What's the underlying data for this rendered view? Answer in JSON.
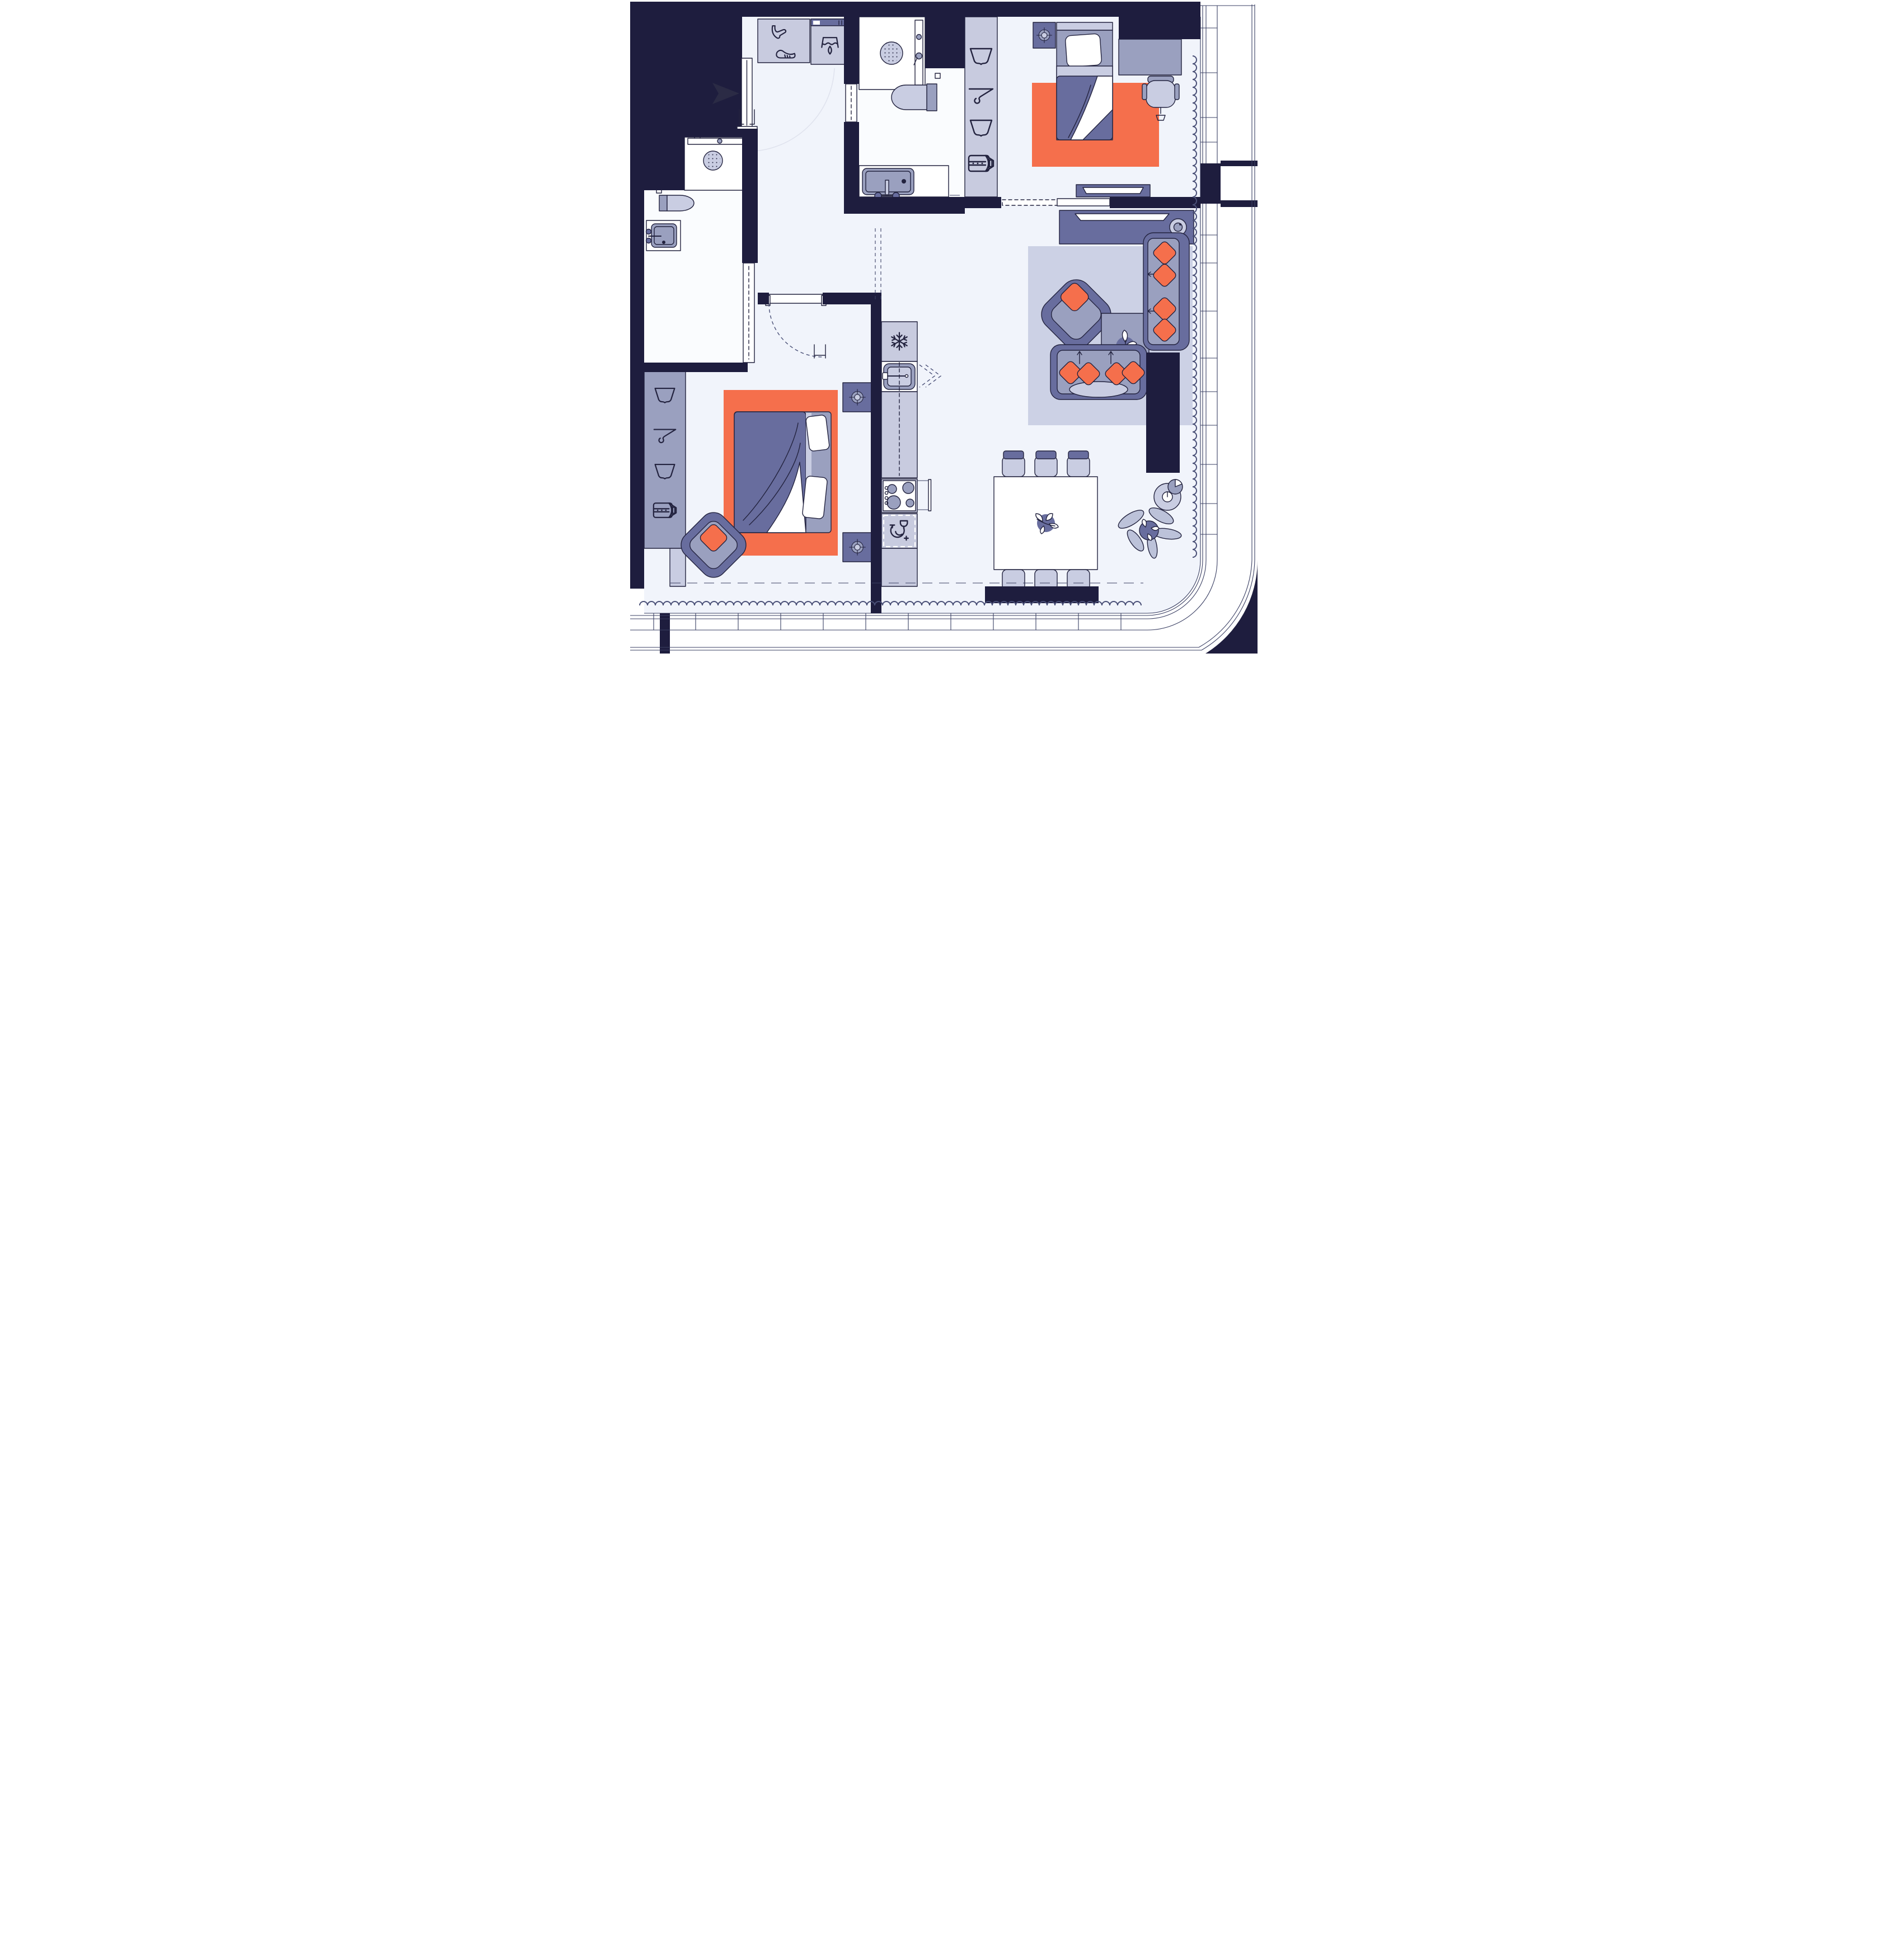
{
  "document": {
    "kind": "apartment-floor-plan",
    "view": "top-down architectural illustration",
    "visible_text": ""
  },
  "colors": {
    "wall": "#1e1d3e",
    "line": "#23233f",
    "line_soft": "#4a5077",
    "exterior_line": "#3a3f63",
    "floor": "#f1f4fb",
    "bath_floor": "#fafcfe",
    "white": "#ffffff",
    "cabinet_light": "#c8cbdf",
    "cabinet_mid": "#686d9e",
    "cabinet_gray": "#9aa0bf",
    "fabric_light": "#c9cde2",
    "rug": "#ccd1e5",
    "orange": "#f56f4c",
    "leaf": "#bcc2d9",
    "arrow": "#2b2b45",
    "arc_faint": "#e0e3ee"
  },
  "rooms": [
    {
      "id": "entry",
      "features": [
        "entry-arrow",
        "entry-door",
        "shoe-cabinet",
        "laundry-cabinet"
      ]
    },
    {
      "id": "hallway",
      "features": [
        "door-swing-arc"
      ]
    },
    {
      "id": "guest-bathroom",
      "features": [
        "walk-in-shower",
        "rain-shower-head",
        "shower-panel",
        "wall-hung-toilet",
        "vanity-sink",
        "pocket-door"
      ]
    },
    {
      "id": "bedroom-2",
      "features": [
        "wardrobe-4-icons",
        "bed",
        "pillow",
        "duvet",
        "orange-rug",
        "nightstand",
        "ring-lamp",
        "desk",
        "desk-chair",
        "tv-dresser",
        "pocket-door"
      ]
    },
    {
      "id": "living-room",
      "features": [
        "tv-console",
        "tv",
        "round-lamp",
        "armchair",
        "orange-pillow",
        "coffee-table",
        "potted-plant",
        "sofa-4-orange-pillows",
        "loveseat-4-orange-pillows",
        "floor-lamp",
        "structural-column",
        "rug"
      ]
    },
    {
      "id": "dining-area",
      "features": [
        "dining-table",
        "dining-chairs-x6",
        "centerpiece-plant"
      ]
    },
    {
      "id": "kitchen",
      "features": [
        "refrigerator",
        "kitchen-sink",
        "counter",
        "cooktop-4-burners",
        "oven-handle",
        "dishwasher"
      ]
    },
    {
      "id": "master-bedroom",
      "features": [
        "double-bed",
        "pillows-x2",
        "duvet",
        "orange-rug",
        "nightstands-x2",
        "ring-lamps",
        "floor-cushion",
        "wardrobe-4-icons",
        "hinged-door"
      ]
    },
    {
      "id": "master-bathroom",
      "features": [
        "walk-in-shower",
        "rain-shower-head",
        "wall-hung-toilet",
        "vanity-sink",
        "pocket-door"
      ]
    },
    {
      "id": "exterior",
      "features": [
        "window-wall-right",
        "window-wall-bottom",
        "balcony",
        "curved-corner-balcony",
        "curtain-wave-lines",
        "corner-plant"
      ]
    }
  ],
  "icons": {
    "tshirt-icon": "clothes storage",
    "hanger-icon": "hanging rail",
    "folded-shirt-belt-icon": "folded clothes with belt",
    "heel-shoe-icon": "shoe storage",
    "sneaker-icon": "shoe storage",
    "garment-icon": "laundry unit",
    "snowflake-icon": "refrigerator",
    "dish-glass-icon": "dishwasher",
    "burner-icon": "cooktop"
  }
}
